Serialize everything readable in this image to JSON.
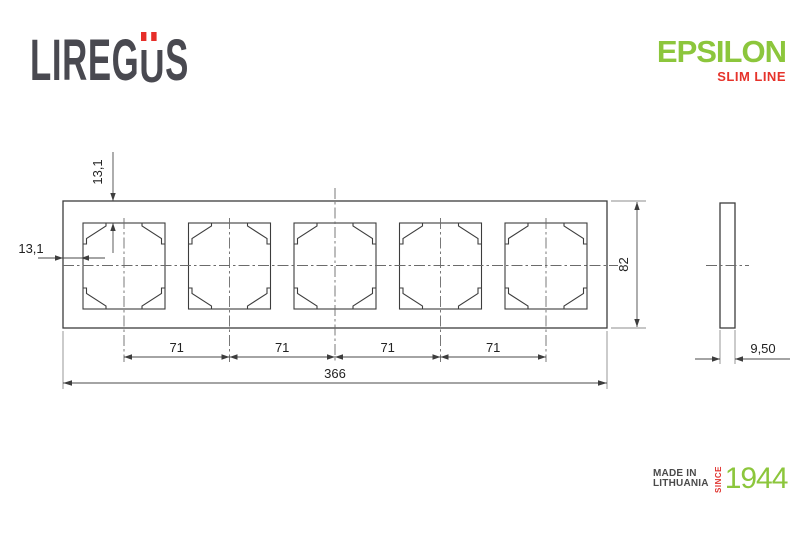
{
  "brand": {
    "logo_pre": "LIREG",
    "logo_u": "U",
    "logo_post": "S"
  },
  "product": {
    "name": "EPSILON",
    "line": "SLIM LINE"
  },
  "origin": {
    "made_in": "MADE IN",
    "country": "LITHUANIA",
    "since": "SINCE",
    "year": "1944"
  },
  "drawing": {
    "gang_count": 5,
    "dims": {
      "total_width": "366",
      "height": "82",
      "spacing": "71",
      "margin_left": "13,1",
      "margin_top": "13,1",
      "depth": "9,50"
    }
  },
  "colors": {
    "accent_green": "#8cc63c",
    "accent_red": "#e6332b",
    "logo_gray": "#494950",
    "line_color": "#3d3d3d"
  }
}
